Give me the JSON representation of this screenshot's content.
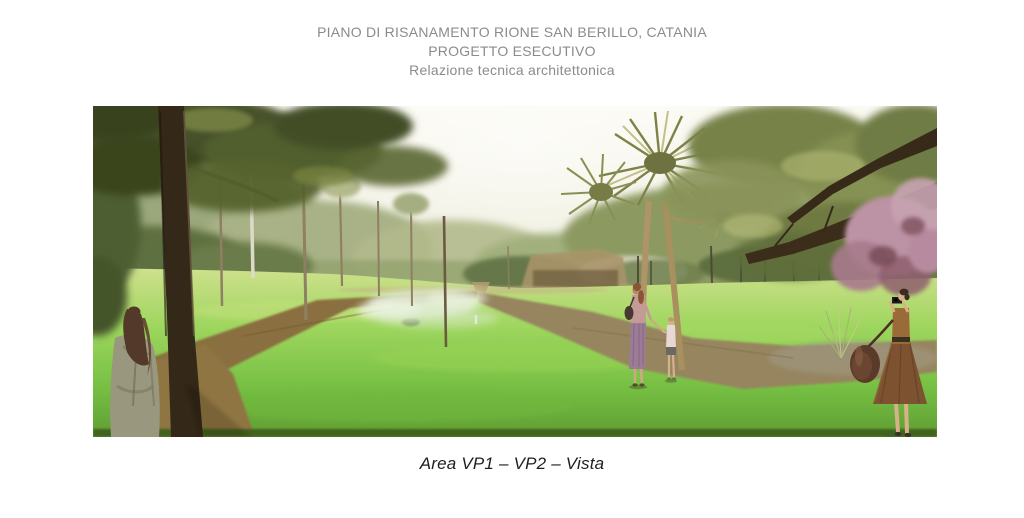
{
  "header": {
    "line1": "PIANO DI RISANAMENTO RIONE SAN BERILLO, CATANIA",
    "line2": "PROGETTO ESECUTIVO",
    "line3": "Relazione tecnica architettonica"
  },
  "figure": {
    "caption": "Area VP1 – VP2 – Vista",
    "alt": "Photorealistic rendering of a park lawn with crossing gravel paths, pine and cordyline palm trees, a woman leaning against a tree in the left foreground, a mother and child walking in the middle distance, and a woman taking a photograph on the right"
  },
  "colors": {
    "page_background": "#ffffff",
    "header_text": "#8b8b8b",
    "caption_text": "#1e1e1e",
    "sky_pale": "#f4f2e8",
    "grass_green": "#7ec549",
    "path_brown": "#8a6f3f",
    "pine_canopy": "#46512a"
  }
}
